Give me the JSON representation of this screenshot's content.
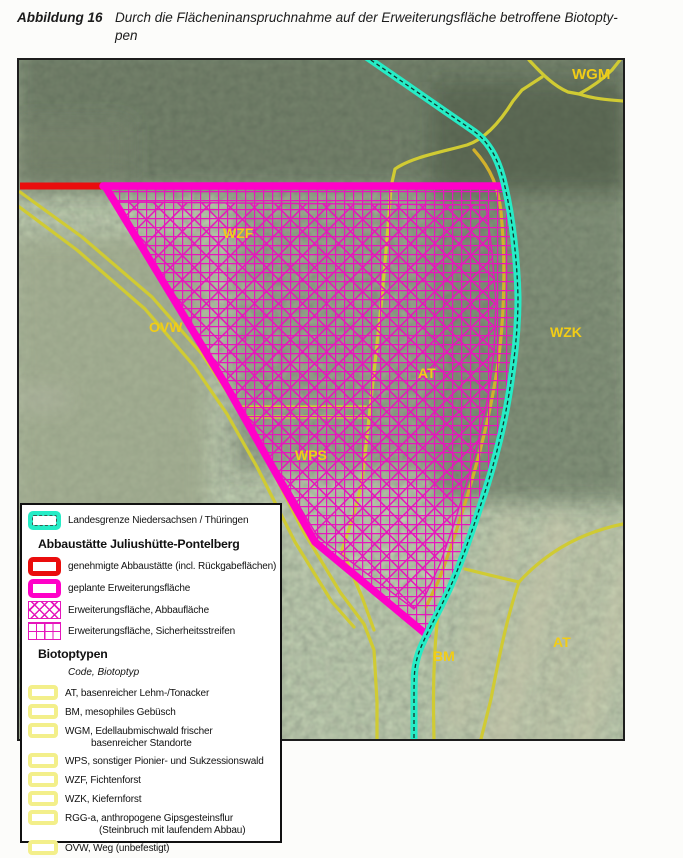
{
  "caption": {
    "label": "Abbildung 16",
    "line1": "Durch die Flächeninanspruchnahme auf der Erweiterungsfläche betroffene Biotopty-",
    "line2": "pen"
  },
  "map": {
    "labels": {
      "wgm": "WGM",
      "wzf": "WZF",
      "ovw": "OVW",
      "wzk": "WZK",
      "at_center": "AT",
      "wps": "WPS",
      "bm": "BM",
      "at_right": "AT"
    },
    "colors": {
      "state_border": "#26ECC6",
      "approved_site": "#EA0D0D",
      "planned_expansion": "#FF00C8",
      "hatch": "#E616BC",
      "biotope_line": "#D0CB33",
      "biotope_label": "#F2CD16"
    }
  },
  "legend": {
    "state_border_label": "Landesgrenze Niedersachsen / Thüringen",
    "abbaustaette": {
      "title": "Abbaustätte Juliushütte-Pontelberg",
      "items": [
        {
          "label": "genehmigte Abbaustätte (incl. Rückgabeflächen)"
        },
        {
          "label": "geplante Erweiterungsfläche"
        },
        {
          "label": "Erweiterungsfläche, Abbaufläche"
        },
        {
          "label": "Erweiterungsfläche, Sicherheitsstreifen"
        }
      ]
    },
    "biotoptypen": {
      "title": "Biotoptypen",
      "subtitle": "Code, Biotoptyp",
      "items": [
        {
          "line1": "AT, basenreicher Lehm-/Tonacker",
          "line2": ""
        },
        {
          "line1": "BM, mesophiles Gebüsch",
          "line2": ""
        },
        {
          "line1": "WGM, Edellaubmischwald frischer",
          "line2": "basenreicher Standorte"
        },
        {
          "line1": "WPS, sonstiger Pionier- und Sukzessionswald",
          "line2": ""
        },
        {
          "line1": "WZF, Fichtenforst",
          "line2": ""
        },
        {
          "line1": "WZK, Kiefernforst",
          "line2": ""
        },
        {
          "line1": "RGG-a, anthropogene Gipsgesteinsflur",
          "line2": "(Steinbruch mit laufendem Abbau)"
        },
        {
          "line1": "OVW, Weg (unbefestigt)",
          "line2": ""
        }
      ]
    }
  }
}
